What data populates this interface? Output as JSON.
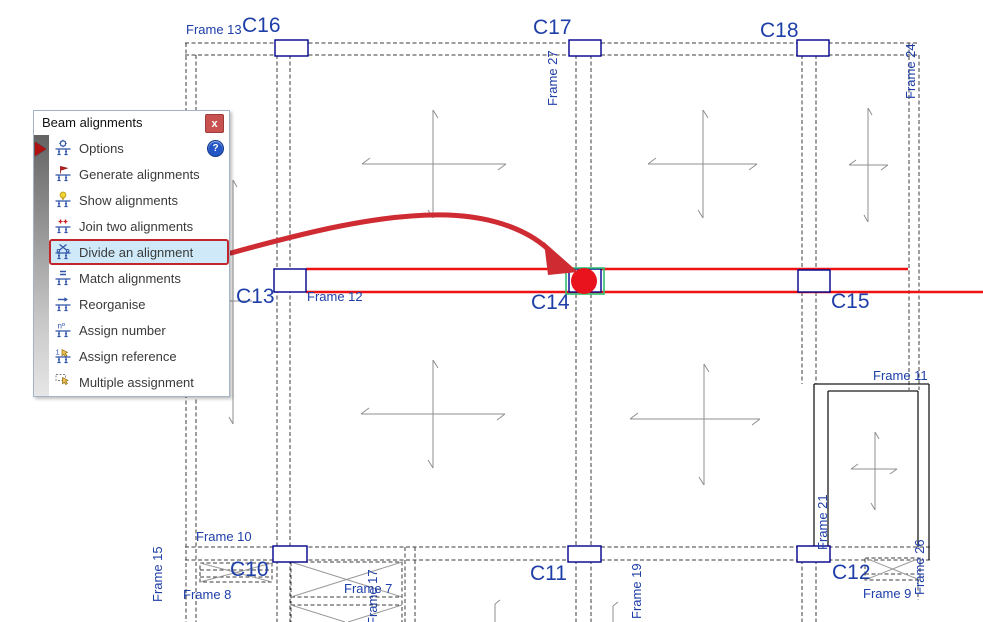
{
  "colors": {
    "label_blue": "#1e3ea8",
    "line_dark": "#3c3c3c",
    "cross_gray": "#8f8f8f",
    "column_blue": "#00008b",
    "highlight_red": "#e8131c",
    "beam_red": "#ee1212",
    "selection_green": "#2fbf71",
    "menu_highlight_bg": "#cfe9f8",
    "menu_highlight_border": "#c2242c",
    "close_red": "#c85250",
    "help_blue": "#2457c5",
    "icon_blue": "#2f54a8"
  },
  "panel": {
    "title": "Beam alignments",
    "close_glyph": "x",
    "help_glyph": "?",
    "items": [
      {
        "label": "Options",
        "icon": "options-gear-icon",
        "has_help": true
      },
      {
        "label": "Generate alignments",
        "icon": "generate-flag-icon"
      },
      {
        "label": "Show alignments",
        "icon": "show-bulb-icon"
      },
      {
        "label": "Join two alignments",
        "icon": "join-alignments-icon"
      },
      {
        "label": "Divide an alignment",
        "icon": "divide-scissors-icon",
        "highlighted": true
      },
      {
        "label": "Match alignments",
        "icon": "match-alignments-icon"
      },
      {
        "label": "Reorganise",
        "icon": "reorganise-arrow-icon"
      },
      {
        "label": "Assign number",
        "icon": "assign-number-icon"
      },
      {
        "label": "Assign reference",
        "icon": "assign-reference-icon"
      },
      {
        "label": "Multiple assignment",
        "icon": "multiple-assignment-icon"
      }
    ]
  },
  "plan": {
    "labels": [
      {
        "text": "Frame 13",
        "kind": "frame",
        "x": 186,
        "y": 23
      },
      {
        "text": "C16",
        "kind": "column",
        "x": 242,
        "y": 15
      },
      {
        "text": "C17",
        "kind": "column",
        "x": 533,
        "y": 17
      },
      {
        "text": "C18",
        "kind": "column",
        "x": 760,
        "y": 20
      },
      {
        "text": "Frame 27",
        "kind": "frame",
        "x": 561,
        "y": 106,
        "rot": true
      },
      {
        "text": "Frame 24",
        "kind": "frame",
        "x": 919,
        "y": 99,
        "rot": true
      },
      {
        "text": "C13",
        "kind": "column",
        "x": 236,
        "y": 286
      },
      {
        "text": "Frame 12",
        "kind": "frame",
        "x": 307,
        "y": 290
      },
      {
        "text": "C14",
        "kind": "column",
        "x": 531,
        "y": 292
      },
      {
        "text": "C15",
        "kind": "column",
        "x": 831,
        "y": 291
      },
      {
        "text": "Frame 11",
        "kind": "frame",
        "x": 873,
        "y": 369
      },
      {
        "text": "Frame 21",
        "kind": "frame",
        "x": 831,
        "y": 550,
        "rot": true
      },
      {
        "text": "Frame 26",
        "kind": "frame",
        "x": 928,
        "y": 595,
        "rot": true
      },
      {
        "text": "Frame 15",
        "kind": "frame",
        "x": 166,
        "y": 602,
        "rot": true
      },
      {
        "text": "Frame 10",
        "kind": "frame",
        "x": 196,
        "y": 530
      },
      {
        "text": "C10",
        "kind": "column",
        "x": 230,
        "y": 559
      },
      {
        "text": "Frame 8",
        "kind": "frame",
        "x": 183,
        "y": 588
      },
      {
        "text": "Frame 7",
        "kind": "frame",
        "x": 344,
        "y": 582
      },
      {
        "text": "Frame 17",
        "kind": "frame",
        "x": 381,
        "y": 625,
        "rot": true
      },
      {
        "text": "C11",
        "kind": "column",
        "x": 530,
        "y": 563
      },
      {
        "text": "Frame 19",
        "kind": "frame",
        "x": 645,
        "y": 619,
        "rot": true
      },
      {
        "text": "C12",
        "kind": "column",
        "x": 832,
        "y": 562
      },
      {
        "text": "Frame 9",
        "kind": "frame",
        "x": 863,
        "y": 587
      }
    ]
  }
}
